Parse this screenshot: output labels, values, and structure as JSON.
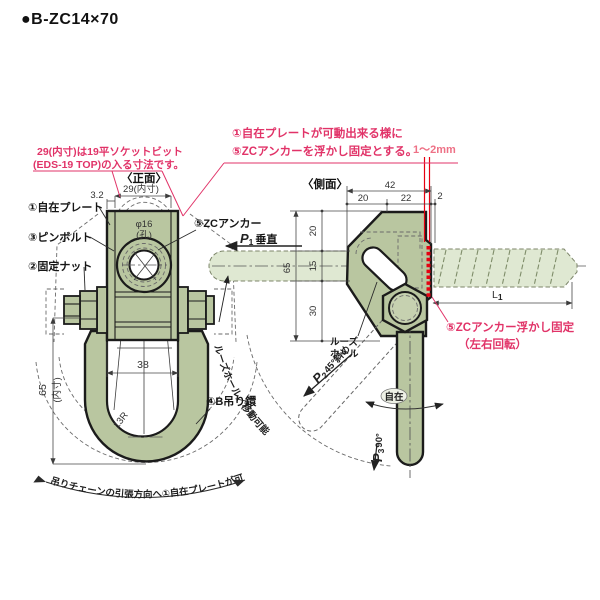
{
  "title": "●B-ZC14×70",
  "colors": {
    "body_green": "#b9c6a0",
    "light_green": "#dfe8d2",
    "outline": "#1b1b1b",
    "pink": "#e13368",
    "pink_light": "#ee7186",
    "red": "#e60012",
    "dim_text": "#333333"
  },
  "notes": {
    "socket_line1": "29(内寸)は19平ソケットビット",
    "socket_line2": "(EDS-19 TOP)の入る寸法です。",
    "top_line1": "①自在プレートが可動出来る様に",
    "top_line2": "⑤ZCアンカーを浮かし固定とする。",
    "gap": "1〜2mm",
    "float_line1": "⑤ZCアンカー浮かし固定",
    "float_line2": "（左右回転）"
  },
  "parts": {
    "p1": "①自在プレート",
    "p2": "②固定ナット",
    "p3": "③ピンボルト",
    "p4": "④B吊り鐶",
    "p5": "⑤ZCアンカー"
  },
  "front": {
    "view_title": "〈正面〉",
    "hole_dia": "φ16",
    "hole_word": "(孔)",
    "dim_top_width": "29(内寸)",
    "dim_plate_t": "3.2",
    "dim_inner_width": "38",
    "dim_inner_height": "65",
    "dim_inner_height_note": "(内寸)",
    "dim_radius": "13R",
    "arc_text": "吊りチェーンの引張方向へ①自在プレートが可動"
  },
  "side": {
    "view_title": "〈側面〉",
    "dim_total_w": "42",
    "dim_w1": "20",
    "dim_w2": "22",
    "dim_w3": "2",
    "dim_h1": "20",
    "dim_h2": "15",
    "dim_h3": "30",
    "dim_total_h": "65",
    "len_sym": "L",
    "len_sub": "1",
    "p1_sym": "P",
    "p1_sub": "1",
    "p1_text": "垂直",
    "p2_sym": "P",
    "p2_sub": "2",
    "p2_text": "45°斜め",
    "p3_sym": "P",
    "p3_sub": "3",
    "p3_text": "90°",
    "loose_line1": "ルーズ",
    "loose_line2": "ホール",
    "arc_label": "ルーズホール／移動可能",
    "swivel": "自在"
  }
}
